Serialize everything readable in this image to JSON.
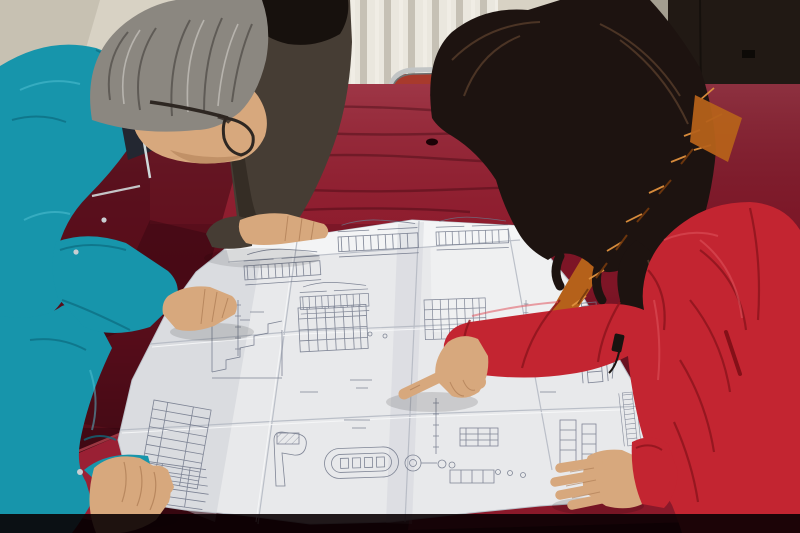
{
  "scene": {
    "caption": "Two workers leaning over a large engineering blueprint spread on a red velvet covered table; a man in a teal work jacket and glasses studies the drawings while a woman in a red hooded parka with orange fur trim points at a detail.",
    "objects": {
      "left_person": "man in teal work jacket with glasses",
      "middle_person": "partially visible person in dark jacket",
      "right_person": "woman in red hooded parka pointing at blueprint",
      "surface": "table covered in crimson velvet",
      "document": "folded engineering blueprint with technical drawings",
      "background": "cream wall with white radiator and dark door"
    }
  },
  "colors": {
    "wall": "#d8d2c4",
    "wall_corner": "#b9b2a4",
    "radiator": "#eae7de",
    "radiator_fin": "#a8a194",
    "stain": "#7b4a21",
    "door_jamb": "#a49e90",
    "door": "#211914",
    "door_latch": "#0d0a07",
    "chair_chrome": "#c2c5c5",
    "chair_seat": "#a83a2c",
    "velvet": "#7e1526",
    "velvet_bright": "#a82338",
    "velvet_corner": "#a42339",
    "velvet_front": "#8e1a2c",
    "velvet_dark": "#2f040e",
    "velvet_shadow": "#0a0103",
    "paper": "#e8e9eb",
    "paper_shade": "#c9ccd3",
    "paper_light": "#f4f5f6",
    "crease": "#b3b8c2",
    "crease_light": "#f7f8f9",
    "ink": "#6d7487",
    "teal": "#1795ab",
    "teal_dark": "#0d6e82",
    "teal_light": "#55c4d6",
    "collar": "#232731",
    "piping": "#cfd9da",
    "button": "#c9ced2",
    "hair_gray": "#8b8780",
    "hair_gray_dark": "#55514c",
    "hair_gray_light": "#c2bfb9",
    "skin": "#d7a87d",
    "skin_shadow": "#ab7a52",
    "glasses": "#2e2722",
    "dark_jacket": "#463d34",
    "hair_black": "#17110d",
    "hair_woman": "#1d1310",
    "hair_shine": "#6b4a33",
    "fur": "#b5611a",
    "fur_light": "#e0913e",
    "fur_dark": "#743a0d",
    "coat": "#c32531",
    "coat_dark": "#8c141d",
    "coat_deep": "#841018",
    "coat_light": "#e0565e",
    "zipper": "#191310"
  }
}
